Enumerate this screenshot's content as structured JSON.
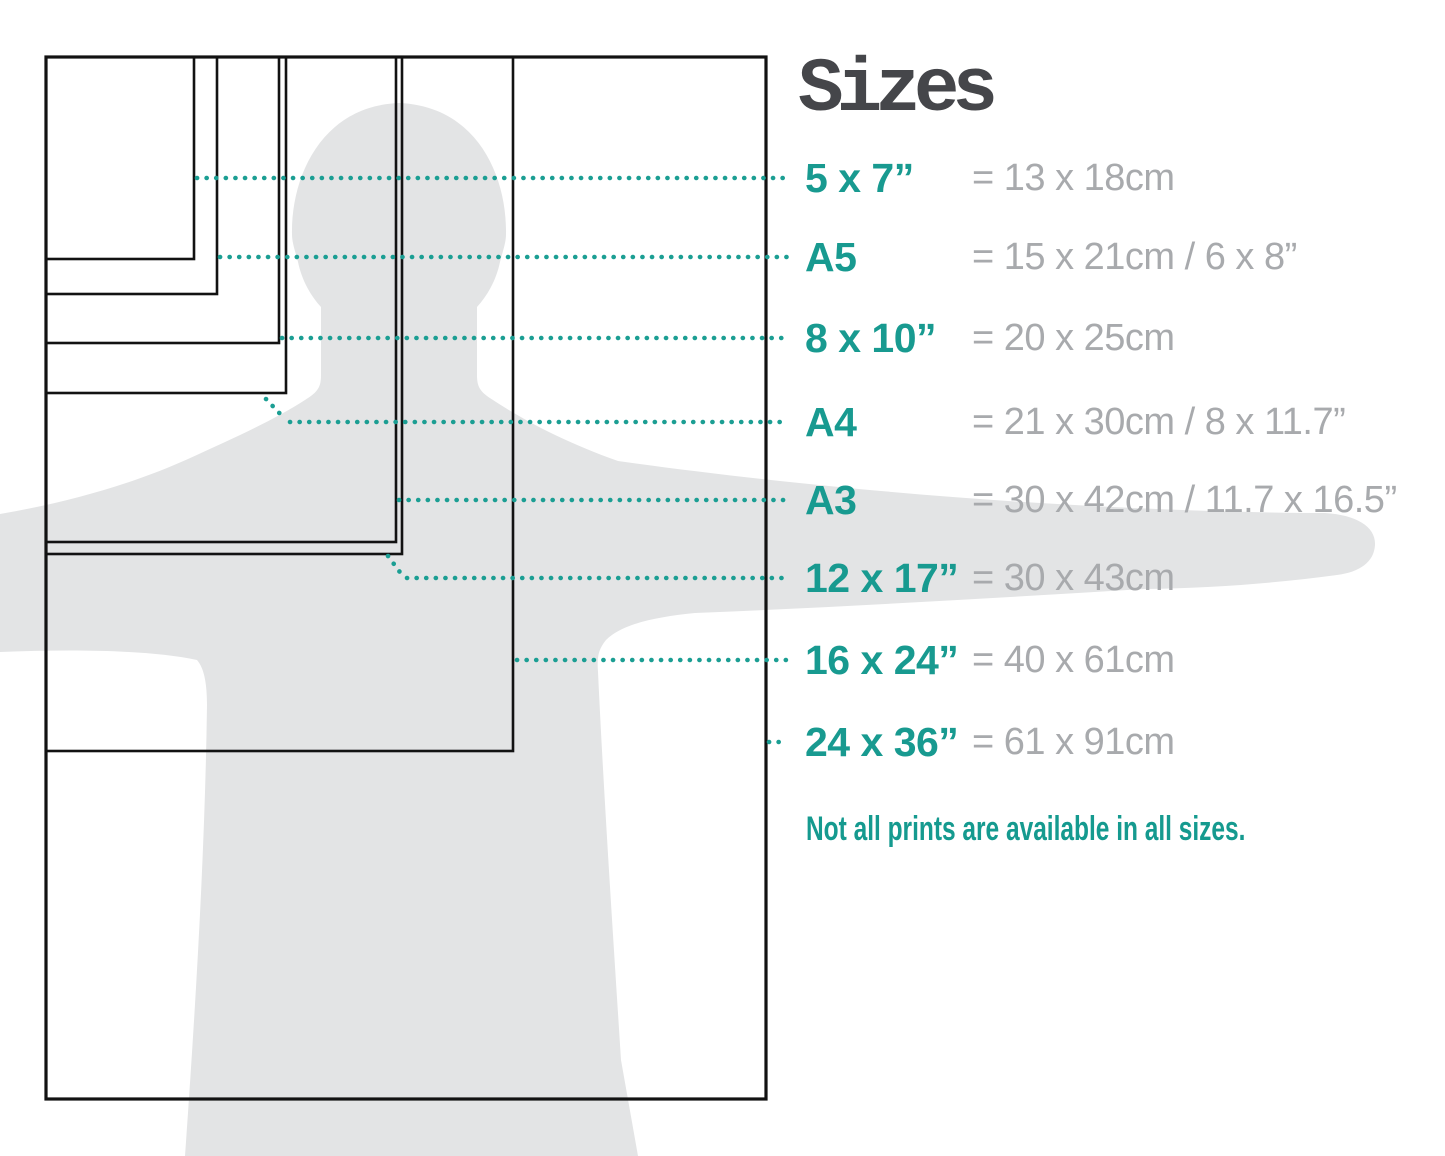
{
  "title": "Sizes",
  "rows": [
    {
      "label": "5 x 7”",
      "value": "= 13 x 18cm"
    },
    {
      "label": "A5",
      "value": "= 15 x 21cm / 6 x 8”"
    },
    {
      "label": "8 x 10”",
      "value": "= 20 x 25cm"
    },
    {
      "label": "A4",
      "value": "= 21 x 30cm / 8 x 11.7”"
    },
    {
      "label": "A3",
      "value": "= 30 x 42cm / 11.7 x 16.5”"
    },
    {
      "label": "12 x 17”",
      "value": "= 30 x 43cm"
    },
    {
      "label": "16 x 24”",
      "value": "= 40 x 61cm"
    },
    {
      "label": "24 x 36”",
      "value": "= 61 x 91cm"
    }
  ],
  "footnote": "Not all prints are available in all sizes.",
  "colors": {
    "accent_teal": "#189a90",
    "dot_teal": "#1b9e93",
    "value_gray": "#a8aaad",
    "title_gray": "#45464a",
    "silhouette_gray": "#e3e4e5",
    "outline_black": "#121212"
  }
}
